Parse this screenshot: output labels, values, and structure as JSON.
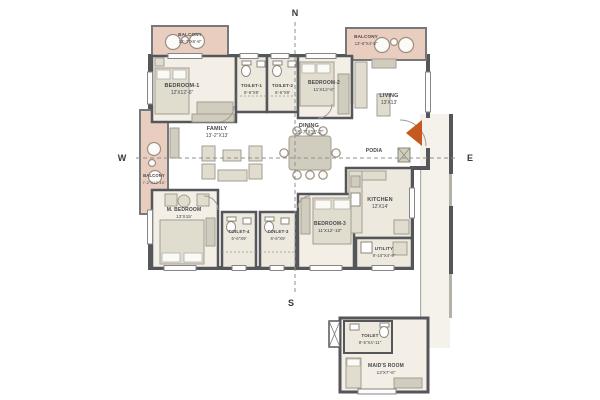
{
  "title": "Apartment floor plan",
  "compass": {
    "north": "N",
    "south": "S",
    "east": "E",
    "west": "W"
  },
  "rooms": {
    "balcony1": {
      "name": "BALCONY",
      "dims": "12'-7\"X6'-8\""
    },
    "bedroom1": {
      "name": "BEDROOM-1",
      "dims": "12'X12'-6\""
    },
    "toilet1": {
      "name": "TOILET-1",
      "dims": "6'-6\"X9'"
    },
    "toilet2": {
      "name": "TOILET-2",
      "dims": "6'-6\"X9'"
    },
    "bedroom2": {
      "name": "BEDROOM-2",
      "dims": "11'X12'-6\""
    },
    "balcony2": {
      "name": "BALCONY",
      "dims": "13'-6\"X4'-8\""
    },
    "living": {
      "name": "LIVING",
      "dims": "13'X13'"
    },
    "balcony3": {
      "name": "BALCONY",
      "dims": "7'-2\"X12'-10\""
    },
    "family": {
      "name": "FAMILY",
      "dims": "13'-2\"X13'"
    },
    "dining": {
      "name": "DINING",
      "dims": "18'-7\"X15'-2\""
    },
    "podia": {
      "name": "PODIA",
      "dims": ""
    },
    "kitchen": {
      "name": "KITCHEN",
      "dims": "12'X14'"
    },
    "mbedroom": {
      "name": "M. BEDROOM",
      "dims": "13'X15'"
    },
    "toilet4": {
      "name": "TOILET-4",
      "dims": "6'-6\"X9'"
    },
    "toilet3": {
      "name": "TOILET-3",
      "dims": "6'-6\"X9'"
    },
    "bedroom3": {
      "name": "BEDROOM-3",
      "dims": "11'X12'-10\""
    },
    "utility": {
      "name": "UTILITY",
      "dims": "9'-10\"X4'-9\""
    },
    "toilet5": {
      "name": "TOILET",
      "dims": "8'-5\"X4'-11\""
    },
    "maidsroom": {
      "name": "MAID'S ROOM",
      "dims": "13'X7'-6\""
    }
  },
  "colors": {
    "wall": "#55565a",
    "floor": "#f3efe6",
    "wet_floor": "#eee9df",
    "balcony": "#e9cec0",
    "corridor": "#f5f2eb",
    "entry_arrow": "#c65a1e"
  }
}
